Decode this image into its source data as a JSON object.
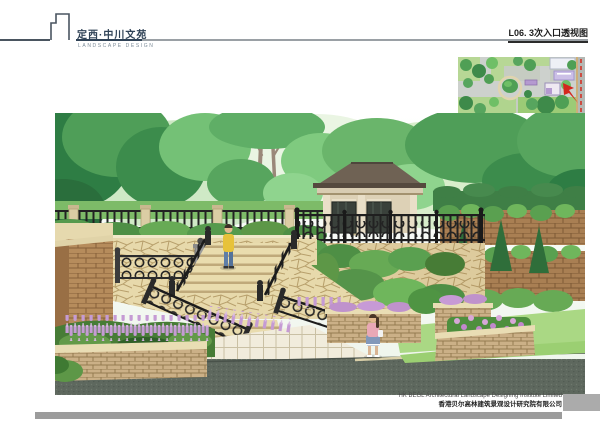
{
  "header": {
    "title": "定西·中川文苑",
    "subtitle": "LANDSCAPE DESIGN",
    "drawing_label": "L06. 3次入口透视图"
  },
  "footer": {
    "company_en": "HK BEGL Architectural Landscape Designing Institute Limited",
    "company_cn": "香港贝尔高林建筑景观设计研究院有限公司"
  },
  "icons": {
    "logo": "building-outline-logo",
    "view_arrow": "view-direction-arrow"
  },
  "colors": {
    "title-color": "#2f4256",
    "rule-color": "#9aa0a5",
    "rule-dark": "#4a5560",
    "label-color": "#1c1c1c",
    "footer-bar": "#9c9c9c",
    "accent-red": "#d4281e",
    "foliage-green": "#55a25c",
    "paving-beige": "#e7d9ac",
    "road-gray": "#5e685e"
  }
}
